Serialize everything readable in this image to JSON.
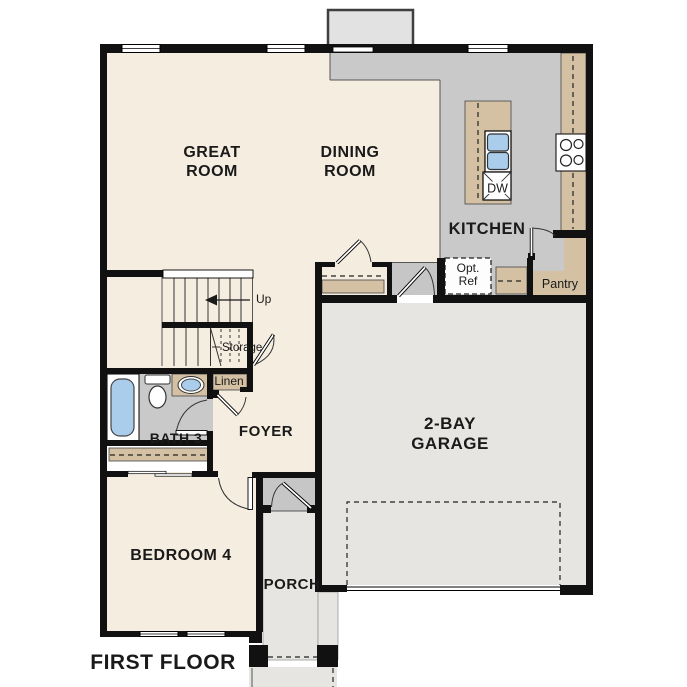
{
  "title": "FIRST FLOOR",
  "rooms": {
    "great_room": {
      "line1": "GREAT",
      "line2": "ROOM"
    },
    "dining_room": {
      "line1": "DINING",
      "line2": "ROOM"
    },
    "kitchen": {
      "label": "KITCHEN"
    },
    "garage": {
      "line1": "2-BAY",
      "line2": "GARAGE"
    },
    "bedroom4": {
      "label": "BEDROOM 4"
    },
    "foyer": {
      "label": "FOYER"
    },
    "porch": {
      "label": "PORCH"
    },
    "bath3": {
      "label": "BATH 3"
    },
    "pantry": {
      "label": "Pantry"
    },
    "linen": {
      "label": "Linen"
    },
    "storage": {
      "label": "Storage"
    }
  },
  "annotations": {
    "up": "Up",
    "opt_ref_line1": "Opt.",
    "opt_ref_line2": "Ref",
    "dishwasher": "DW"
  },
  "colors": {
    "wall": "#111111",
    "living_floor": "#f5ede0",
    "kitchen_floor": "#c9c9c9",
    "garage_floor": "#e6e5e2",
    "entry_tile": "#c6c6c6",
    "counter_tan": "#d4c1a4",
    "water_blue": "#aacdec",
    "bumpout_fill": "#e2e2e2"
  }
}
